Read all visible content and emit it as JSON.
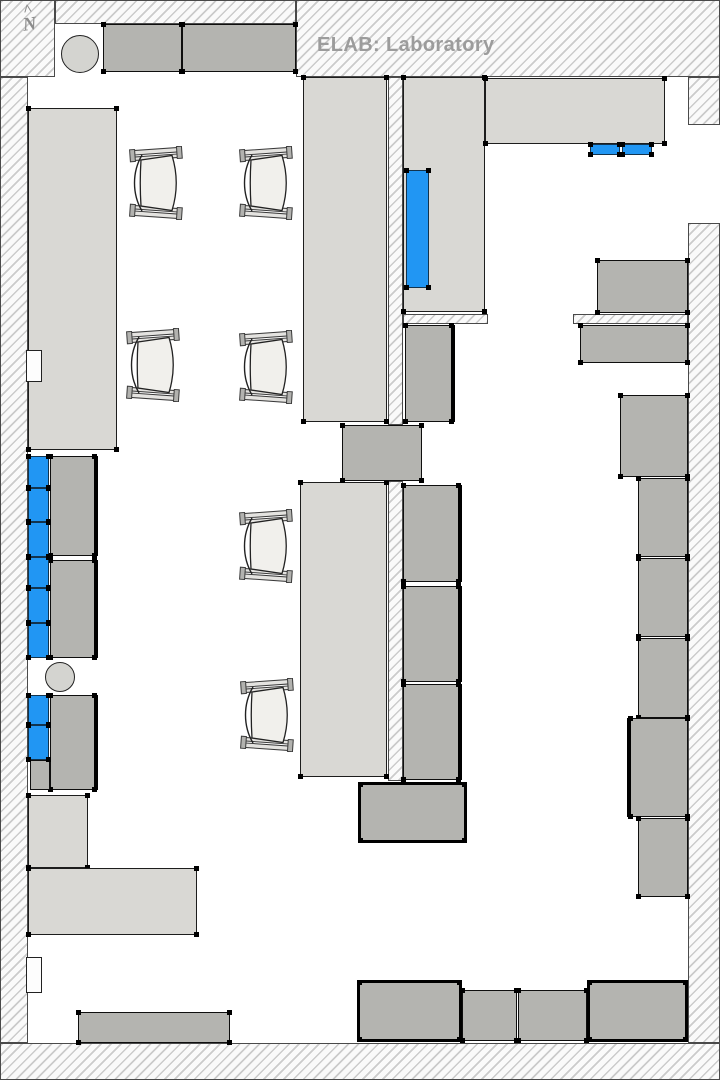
{
  "title": "ELAB: Laboratory",
  "north": {
    "caret": "^",
    "label": "N"
  },
  "colors": {
    "highlight_blue": "#2196f3",
    "counter_fill": "#d9d8d4",
    "equipment_fill": "#b4b4b0",
    "chair_seat_fill": "#f1f0ec",
    "wall_hatch_line": "#cbcbcb",
    "title_text": "#9c9c9c"
  },
  "floorplan": {
    "walls": [
      {
        "n": "wall-top-left-block",
        "x": 0,
        "y": 0,
        "w": 55,
        "h": 77
      },
      {
        "n": "wall-top-strip",
        "x": 55,
        "y": 0,
        "w": 241,
        "h": 24
      },
      {
        "n": "wall-top-right",
        "x": 296,
        "y": 0,
        "w": 424,
        "h": 77
      },
      {
        "n": "wall-left",
        "x": 0,
        "y": 77,
        "w": 28,
        "h": 966
      },
      {
        "n": "wall-bottom",
        "x": 0,
        "y": 1043,
        "w": 720,
        "h": 37
      },
      {
        "n": "wall-east-upper-tab",
        "x": 688,
        "y": 77,
        "w": 32,
        "h": 48
      },
      {
        "n": "wall-east",
        "x": 688,
        "y": 223,
        "w": 32,
        "h": 820
      },
      {
        "n": "wall-mid-vertical-upper",
        "x": 388,
        "y": 77,
        "w": 15,
        "h": 348
      },
      {
        "n": "wall-mid-vertical-lower",
        "x": 388,
        "y": 481,
        "w": 15,
        "h": 300
      },
      {
        "n": "wall-stub-left",
        "x": 403,
        "y": 314,
        "w": 85,
        "h": 10
      },
      {
        "n": "wall-stub-right",
        "x": 573,
        "y": 314,
        "w": 115,
        "h": 10
      }
    ],
    "counters": [
      {
        "n": "counter-left-upper",
        "x": 28,
        "y": 108,
        "w": 89,
        "h": 342,
        "t": 1
      },
      {
        "n": "bench-center-upper",
        "x": 303,
        "y": 77,
        "w": 84,
        "h": 345,
        "t": 1
      },
      {
        "n": "bench-center-lower",
        "x": 300,
        "y": 482,
        "w": 87,
        "h": 295,
        "t": 1
      },
      {
        "n": "counter-midright-vertical",
        "x": 403,
        "y": 77,
        "w": 82,
        "h": 235,
        "t": 1
      },
      {
        "n": "counter-top-right",
        "x": 485,
        "y": 78,
        "w": 180,
        "h": 66,
        "t": 1
      },
      {
        "n": "counter-bottomleft-vertical",
        "x": 28,
        "y": 795,
        "w": 60,
        "h": 73,
        "t": 1
      },
      {
        "n": "counter-bottomleft-horizontal",
        "x": 28,
        "y": 868,
        "w": 169,
        "h": 67,
        "t": 1
      }
    ],
    "equipment": [
      {
        "n": "cabinet-top-1",
        "x": 103,
        "y": 24,
        "w": 79,
        "h": 48,
        "t": 1
      },
      {
        "n": "cabinet-top-2",
        "x": 182,
        "y": 24,
        "w": 114,
        "h": 48,
        "t": 1
      },
      {
        "n": "equipment-center-passage",
        "x": 342,
        "y": 425,
        "w": 80,
        "h": 56,
        "t": 1
      },
      {
        "n": "equipment-midright-lower",
        "x": 405,
        "y": 325,
        "w": 50,
        "h": 97,
        "hv": "r",
        "t": 1
      },
      {
        "n": "equipment-center-col-1",
        "x": 403,
        "y": 485,
        "w": 59,
        "h": 97,
        "hv": "r",
        "t": 1
      },
      {
        "n": "equipment-center-col-2",
        "x": 403,
        "y": 586,
        "w": 59,
        "h": 96,
        "hv": "r",
        "t": 1
      },
      {
        "n": "equipment-center-col-3",
        "x": 403,
        "y": 684,
        "w": 59,
        "h": 96,
        "hv": "r",
        "t": 1
      },
      {
        "n": "equipment-center-bottom",
        "x": 358,
        "y": 782,
        "w": 109,
        "h": 61,
        "hv": "all",
        "t": 1
      },
      {
        "n": "cabinet-left-1",
        "x": 50,
        "y": 456,
        "w": 48,
        "h": 100,
        "hv": "r",
        "t": 1
      },
      {
        "n": "cabinet-left-2",
        "x": 50,
        "y": 560,
        "w": 48,
        "h": 98,
        "hv": "r",
        "t": 1
      },
      {
        "n": "cabinet-left-3",
        "x": 50,
        "y": 695,
        "w": 48,
        "h": 95,
        "hv": "r",
        "t": 1
      },
      {
        "n": "cabinet-left-3-ext",
        "x": 30,
        "y": 760,
        "w": 20,
        "h": 30,
        "t": 0
      },
      {
        "n": "bench-bottom-left",
        "x": 78,
        "y": 1012,
        "w": 152,
        "h": 31,
        "t": 1
      },
      {
        "n": "equipment-east-1",
        "x": 597,
        "y": 260,
        "w": 91,
        "h": 53,
        "t": 1
      },
      {
        "n": "equipment-east-2",
        "x": 580,
        "y": 325,
        "w": 108,
        "h": 38,
        "t": 1
      },
      {
        "n": "equipment-east-3",
        "x": 620,
        "y": 395,
        "w": 68,
        "h": 82,
        "t": 1
      },
      {
        "n": "equipment-east-4",
        "x": 638,
        "y": 478,
        "w": 50,
        "h": 79,
        "t": 1
      },
      {
        "n": "equipment-east-5",
        "x": 638,
        "y": 558,
        "w": 50,
        "h": 79,
        "t": 1
      },
      {
        "n": "equipment-east-6",
        "x": 638,
        "y": 638,
        "w": 50,
        "h": 80,
        "t": 1
      },
      {
        "n": "equipment-east-7",
        "x": 627,
        "y": 718,
        "w": 61,
        "h": 99,
        "hv": "l",
        "t": 1
      },
      {
        "n": "equipment-east-8",
        "x": 638,
        "y": 818,
        "w": 50,
        "h": 79,
        "t": 1
      },
      {
        "n": "equipment-bottom-1",
        "x": 357,
        "y": 980,
        "w": 105,
        "h": 62,
        "hv": "all",
        "t": 1
      },
      {
        "n": "equipment-bottom-2",
        "x": 462,
        "y": 990,
        "w": 55,
        "h": 51,
        "t": 1
      },
      {
        "n": "equipment-bottom-3",
        "x": 518,
        "y": 990,
        "w": 69,
        "h": 51,
        "t": 1
      },
      {
        "n": "equipment-bottom-4",
        "x": 587,
        "y": 980,
        "w": 101,
        "h": 62,
        "hv": "all",
        "t": 1
      }
    ],
    "highlights": [
      {
        "n": "highlighted-equipment-midright",
        "x": 406,
        "y": 170,
        "w": 23,
        "h": 118,
        "t": 1
      },
      {
        "n": "highlighted-equipment-topright-1",
        "x": 590,
        "y": 144,
        "w": 30,
        "h": 11,
        "t": 1
      },
      {
        "n": "highlighted-equipment-topright-2",
        "x": 622,
        "y": 144,
        "w": 30,
        "h": 11,
        "t": 1
      },
      {
        "n": "highlighted-cabinet-left-1",
        "x": 28,
        "y": 456,
        "w": 21,
        "h": 32,
        "t": 1
      },
      {
        "n": "highlighted-cabinet-left-2",
        "x": 28,
        "y": 488,
        "w": 21,
        "h": 34,
        "t": 1
      },
      {
        "n": "highlighted-cabinet-left-3",
        "x": 28,
        "y": 522,
        "w": 21,
        "h": 35,
        "t": 1
      },
      {
        "n": "highlighted-cabinet-left-4",
        "x": 28,
        "y": 557,
        "w": 21,
        "h": 31,
        "t": 1
      },
      {
        "n": "highlighted-cabinet-left-5",
        "x": 28,
        "y": 588,
        "w": 21,
        "h": 35,
        "t": 1
      },
      {
        "n": "highlighted-cabinet-left-6",
        "x": 28,
        "y": 623,
        "w": 21,
        "h": 35,
        "t": 1
      },
      {
        "n": "highlighted-cabinet-left-7",
        "x": 28,
        "y": 695,
        "w": 21,
        "h": 30,
        "t": 1
      },
      {
        "n": "highlighted-cabinet-left-8",
        "x": 28,
        "y": 725,
        "w": 21,
        "h": 35,
        "t": 1
      }
    ],
    "notches": [
      {
        "n": "wall-recess-upper",
        "x": 26,
        "y": 350,
        "w": 16,
        "h": 32
      },
      {
        "n": "wall-recess-lower",
        "x": 26,
        "y": 957,
        "w": 16,
        "h": 36
      }
    ],
    "circles": [
      {
        "n": "stool-top-left",
        "cx": 80,
        "cy": 54,
        "r": 19
      },
      {
        "n": "stool-left-middle",
        "cx": 60,
        "cy": 677,
        "r": 15
      }
    ],
    "chairs": [
      {
        "n": "chair-1",
        "x": 128,
        "y": 146
      },
      {
        "n": "chair-2",
        "x": 238,
        "y": 146
      },
      {
        "n": "chair-3",
        "x": 125,
        "y": 328
      },
      {
        "n": "chair-4",
        "x": 238,
        "y": 330
      },
      {
        "n": "chair-5",
        "x": 238,
        "y": 509
      },
      {
        "n": "chair-6",
        "x": 239,
        "y": 678
      }
    ]
  }
}
